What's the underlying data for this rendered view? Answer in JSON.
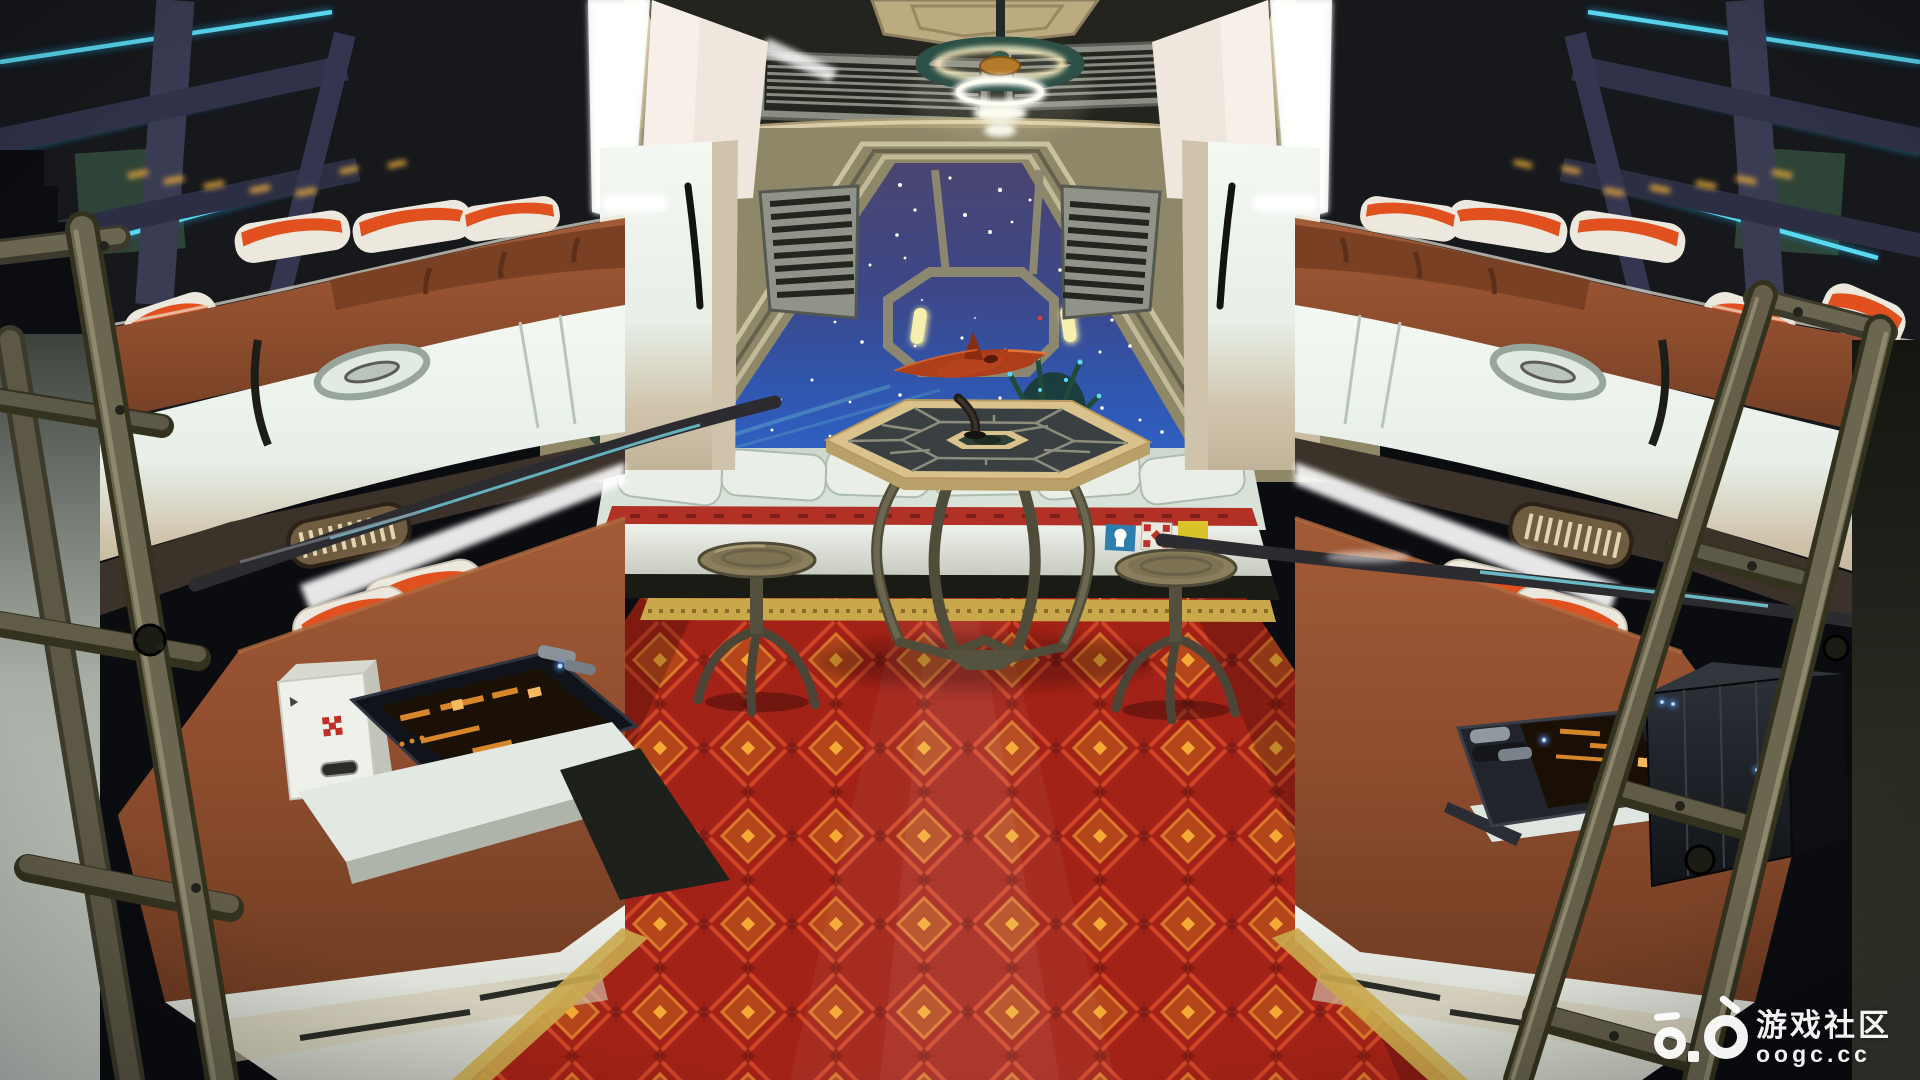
{
  "scene": {
    "label": "Spaceship crew quarters interior: symmetric bunk beds, viewport window with starfield, model starship on a hexagonal table, two stools, red diamond-pattern carpet, neon-lit storage shelves and boarding ladders",
    "objects": [
      "ceiling ring light",
      "viewport window with starfield",
      "octagonal outer window frame",
      "model starship on pedestal table",
      "metal stool left",
      "metal stool right",
      "red patterned carpet",
      "bunk beds left",
      "bunk beds right",
      "storage shelves with cyan neon tubes",
      "orange-white pillows",
      "boarding ladder left",
      "boarding ladder right",
      "potted plants",
      "window bench with decals",
      "medical kit box",
      "console tablet",
      "server unit with blue LEDs",
      "ceiling vents"
    ]
  },
  "watermark": {
    "site_name": "游戏社区",
    "site_url": "oogc.cc"
  },
  "colors": {
    "ceiling_tan": "#b3a47c",
    "ceiling_recess": "#23241d",
    "wall_khaki": "#8e8869",
    "frame_light": "#c9c2a0",
    "window_space_top": "#4a4570",
    "window_space_bottom": "#2f5fc0",
    "star_white": "#ffffff",
    "porthole_yellow": "#ede69c",
    "panel_white": "#e7efe8",
    "panel_cream": "#cfc3ab",
    "mattress_brown": "#8e4d2e",
    "mattress_shadow": "#6f3c22",
    "carpet_red": "#a32217",
    "carpet_accent_orange": "#c8701f",
    "carpet_dot_gold": "#f0a830",
    "fringe_gold": "#c9a84c",
    "neon_cyan": "#5ad8f0",
    "pillow_orange": "#e0511f",
    "pillow_white": "#ece8dd",
    "metal_olive": "#6a6450",
    "rail_dark": "#2b2b30",
    "ship_red": "#b5431d",
    "table_rim_tan": "#d9c28b",
    "table_inlay_dark": "#3a3f41",
    "decal_blue": "#2e7fae",
    "decal_yellow": "#d8c32a",
    "decal_red": "#c03028",
    "led_blue": "#5598ff",
    "screen_orange": "#d8862a"
  }
}
